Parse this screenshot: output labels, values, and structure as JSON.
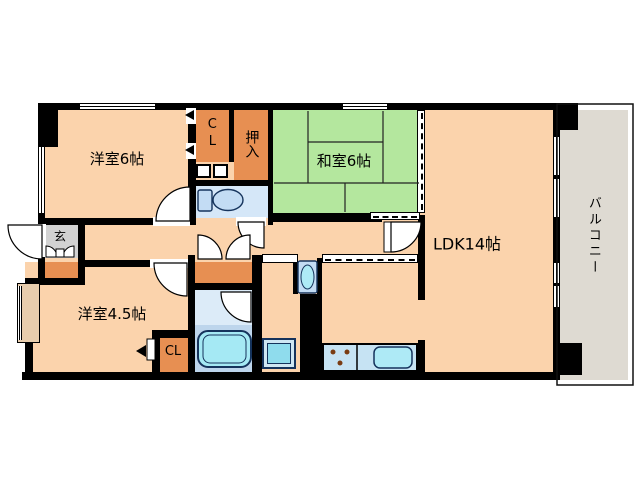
{
  "plan": {
    "rooms": {
      "western6": "洋室6帖",
      "closetTop": "CL",
      "oshiire": "押入",
      "japanese6": "和室6帖",
      "ldk": "LDK14帖",
      "balcony": "バルコニー",
      "entrance": "玄",
      "western45": "洋室4.5帖",
      "closetBottom": "CL"
    }
  },
  "colors": {
    "wall": "#000000",
    "floor": "#fbd3ac",
    "closet": "#e78f52",
    "tatami": "#b4e79e",
    "toilet_room": "#d5e7f8",
    "bath_upper": "#dcebf8",
    "bath_lower": "#bdd5ec",
    "tub": "#a5e9f4",
    "fixture_blue": "#c3dcf4",
    "appliance": "#8fdced",
    "counter": "#c6e3f3",
    "sink": "#aeeaf6",
    "balcony": "#dedad2",
    "entrance_gray": "#d2d2d2",
    "bay_window": "#e8cdad",
    "outline_navy": "#15335c"
  }
}
